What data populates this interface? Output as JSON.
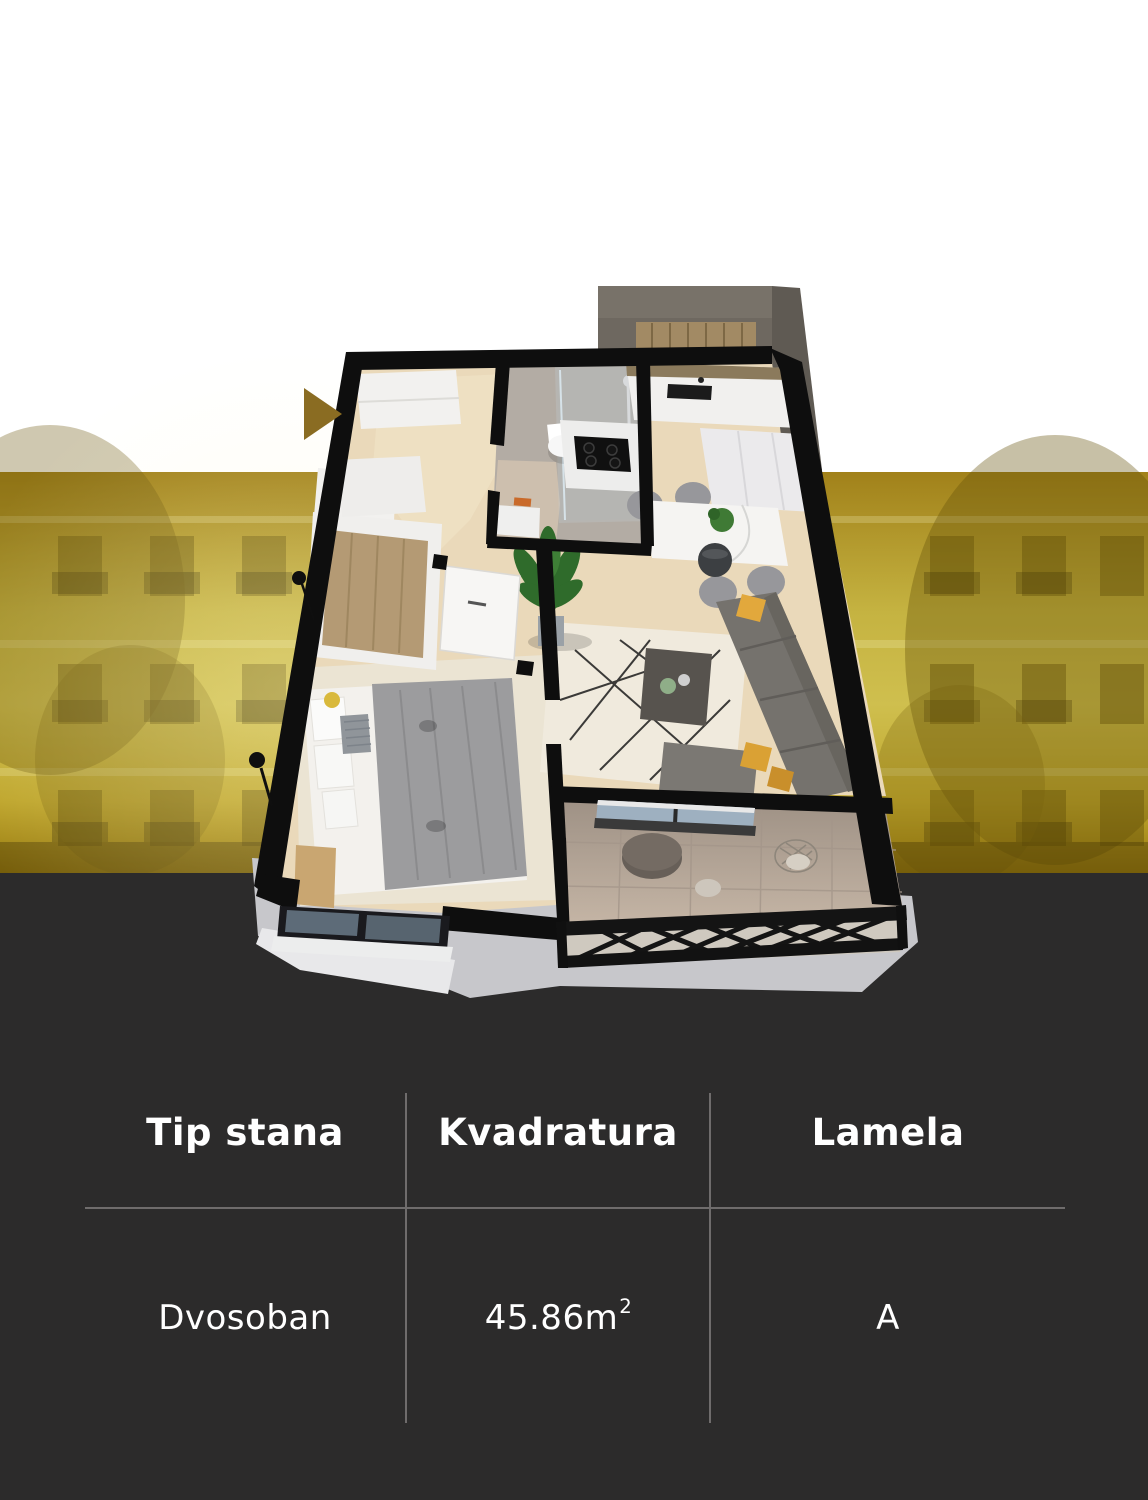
{
  "sections": {
    "background_top_color": "#ffffff",
    "gold_band_color": "#c9b83e",
    "dark_section_color": "#2c2b2b"
  },
  "floorplan": {
    "type": "3d-isometric-apartment-render",
    "rooms": [
      "entry-hall",
      "bathroom",
      "kitchen",
      "dining-area",
      "living-room",
      "bedroom",
      "terrace",
      "balcony"
    ],
    "furniture": [
      "kitchen-cabinets",
      "kitchen-island-cooktop",
      "dining-table",
      "pendant-lamp",
      "sofa",
      "coffee-table",
      "potted-plant",
      "double-bed",
      "wardrobe",
      "shower",
      "toilet",
      "terrace-table",
      "wire-chair",
      "lattice-railing"
    ],
    "entrance_arrow_color": "#8a6c22",
    "wall_color": "#0e0e0e",
    "wood_floor_color": "#ead9ba",
    "accent_pillow_color": "#e2a83c"
  },
  "info_table": {
    "text_color": "#ffffff",
    "divider_color": "#6f6c6c",
    "columns": [
      {
        "header": "Tip stana",
        "value": "Dvosoban"
      },
      {
        "header": "Kvadratura",
        "value": "45.86m",
        "superscript": "2"
      },
      {
        "header": "Lamela",
        "value": "A"
      }
    ]
  }
}
